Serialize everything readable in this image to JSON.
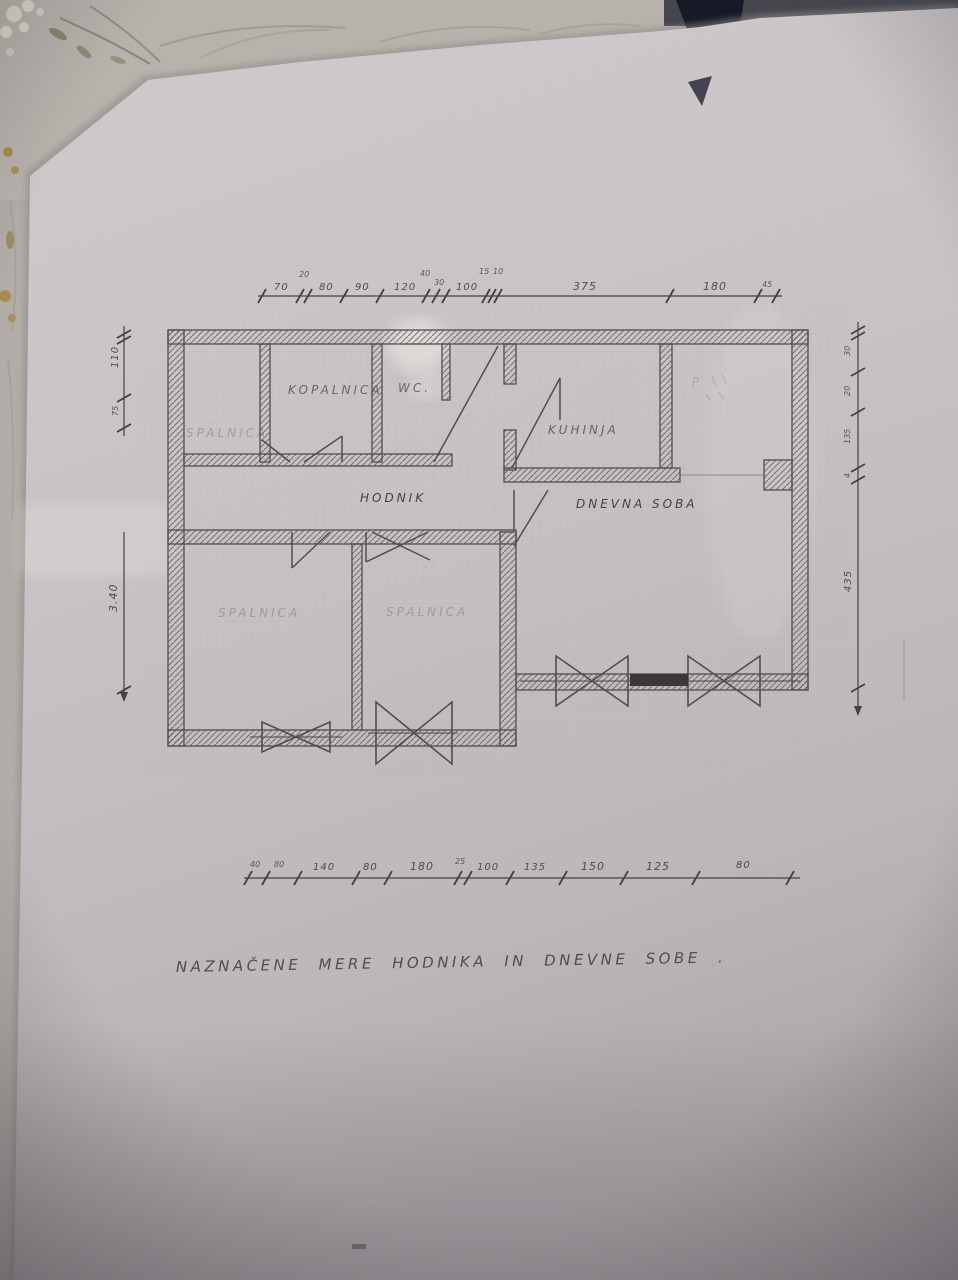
{
  "caption": "NAZNAČENE MERE HODNIKA IN DNEVNE SOBE .",
  "rooms": {
    "nw_bedroom": "SPALNICA",
    "bathroom": "KOPALNICA",
    "wc": "WC.",
    "kitchen": "KUHINJA",
    "ne_room": "P",
    "hall": "HODNIK",
    "living": "DNEVNA SOBA",
    "sw_bedroom": "SPALNICA",
    "s_bedroom": "SPALNICA"
  },
  "dims": {
    "top": [
      "70",
      "20",
      "80",
      "90",
      "120",
      "40",
      "30",
      "100",
      "15",
      "10",
      "375",
      "180",
      "45"
    ],
    "bottom": [
      "40",
      "80",
      "140",
      "80",
      "180",
      "25",
      "100",
      "135",
      "150",
      "125",
      "80"
    ],
    "left_upper": [
      "110",
      "75"
    ],
    "left_lower": [
      "3.40"
    ],
    "right": [
      "30",
      "20",
      "135",
      "4",
      "435"
    ]
  }
}
